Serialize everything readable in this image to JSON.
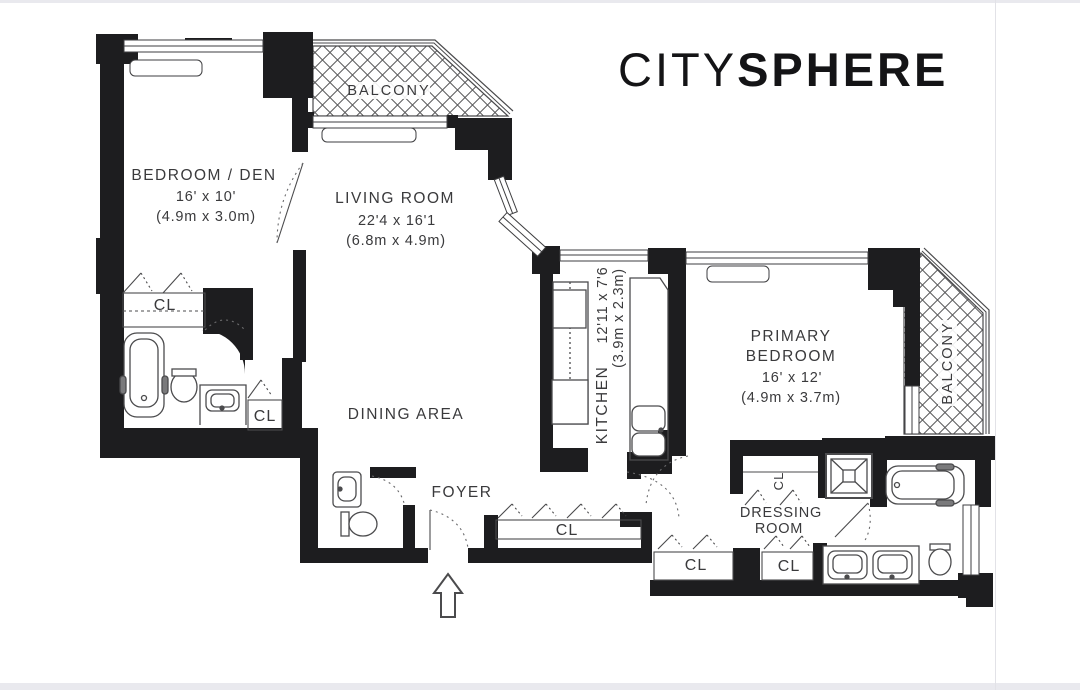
{
  "brand": {
    "light": "CITY",
    "bold": "SPHERE"
  },
  "rooms": {
    "bedroom_den": {
      "name": "BEDROOM / DEN",
      "dims_ft": "16' x 10'",
      "dims_m": "(4.9m x 3.0m)"
    },
    "living_room": {
      "name": "LIVING ROOM",
      "dims_ft": "22'4 x 16'1",
      "dims_m": "(6.8m x 4.9m)"
    },
    "dining_area": {
      "name": "DINING AREA"
    },
    "kitchen": {
      "name": "KITCHEN",
      "dims_ft": "12'11 x 7'6",
      "dims_m": "(3.9m x 2.3m)"
    },
    "primary_bedroom": {
      "name_line1": "PRIMARY",
      "name_line2": "BEDROOM",
      "dims_ft": "16' x 12'",
      "dims_m": "(4.9m x 3.7m)"
    },
    "foyer": {
      "name": "FOYER"
    },
    "dressing_room": {
      "name_line1": "DRESSING",
      "name_line2": "ROOM"
    },
    "balcony_top": {
      "name": "BALCONY"
    },
    "balcony_right": {
      "name": "BALCONY"
    }
  },
  "closets": {
    "label": "CL"
  },
  "colors": {
    "wall": "#1d1d1f",
    "line": "#47474a",
    "text": "#3a3a3c",
    "frame": "#e9e9ee"
  }
}
